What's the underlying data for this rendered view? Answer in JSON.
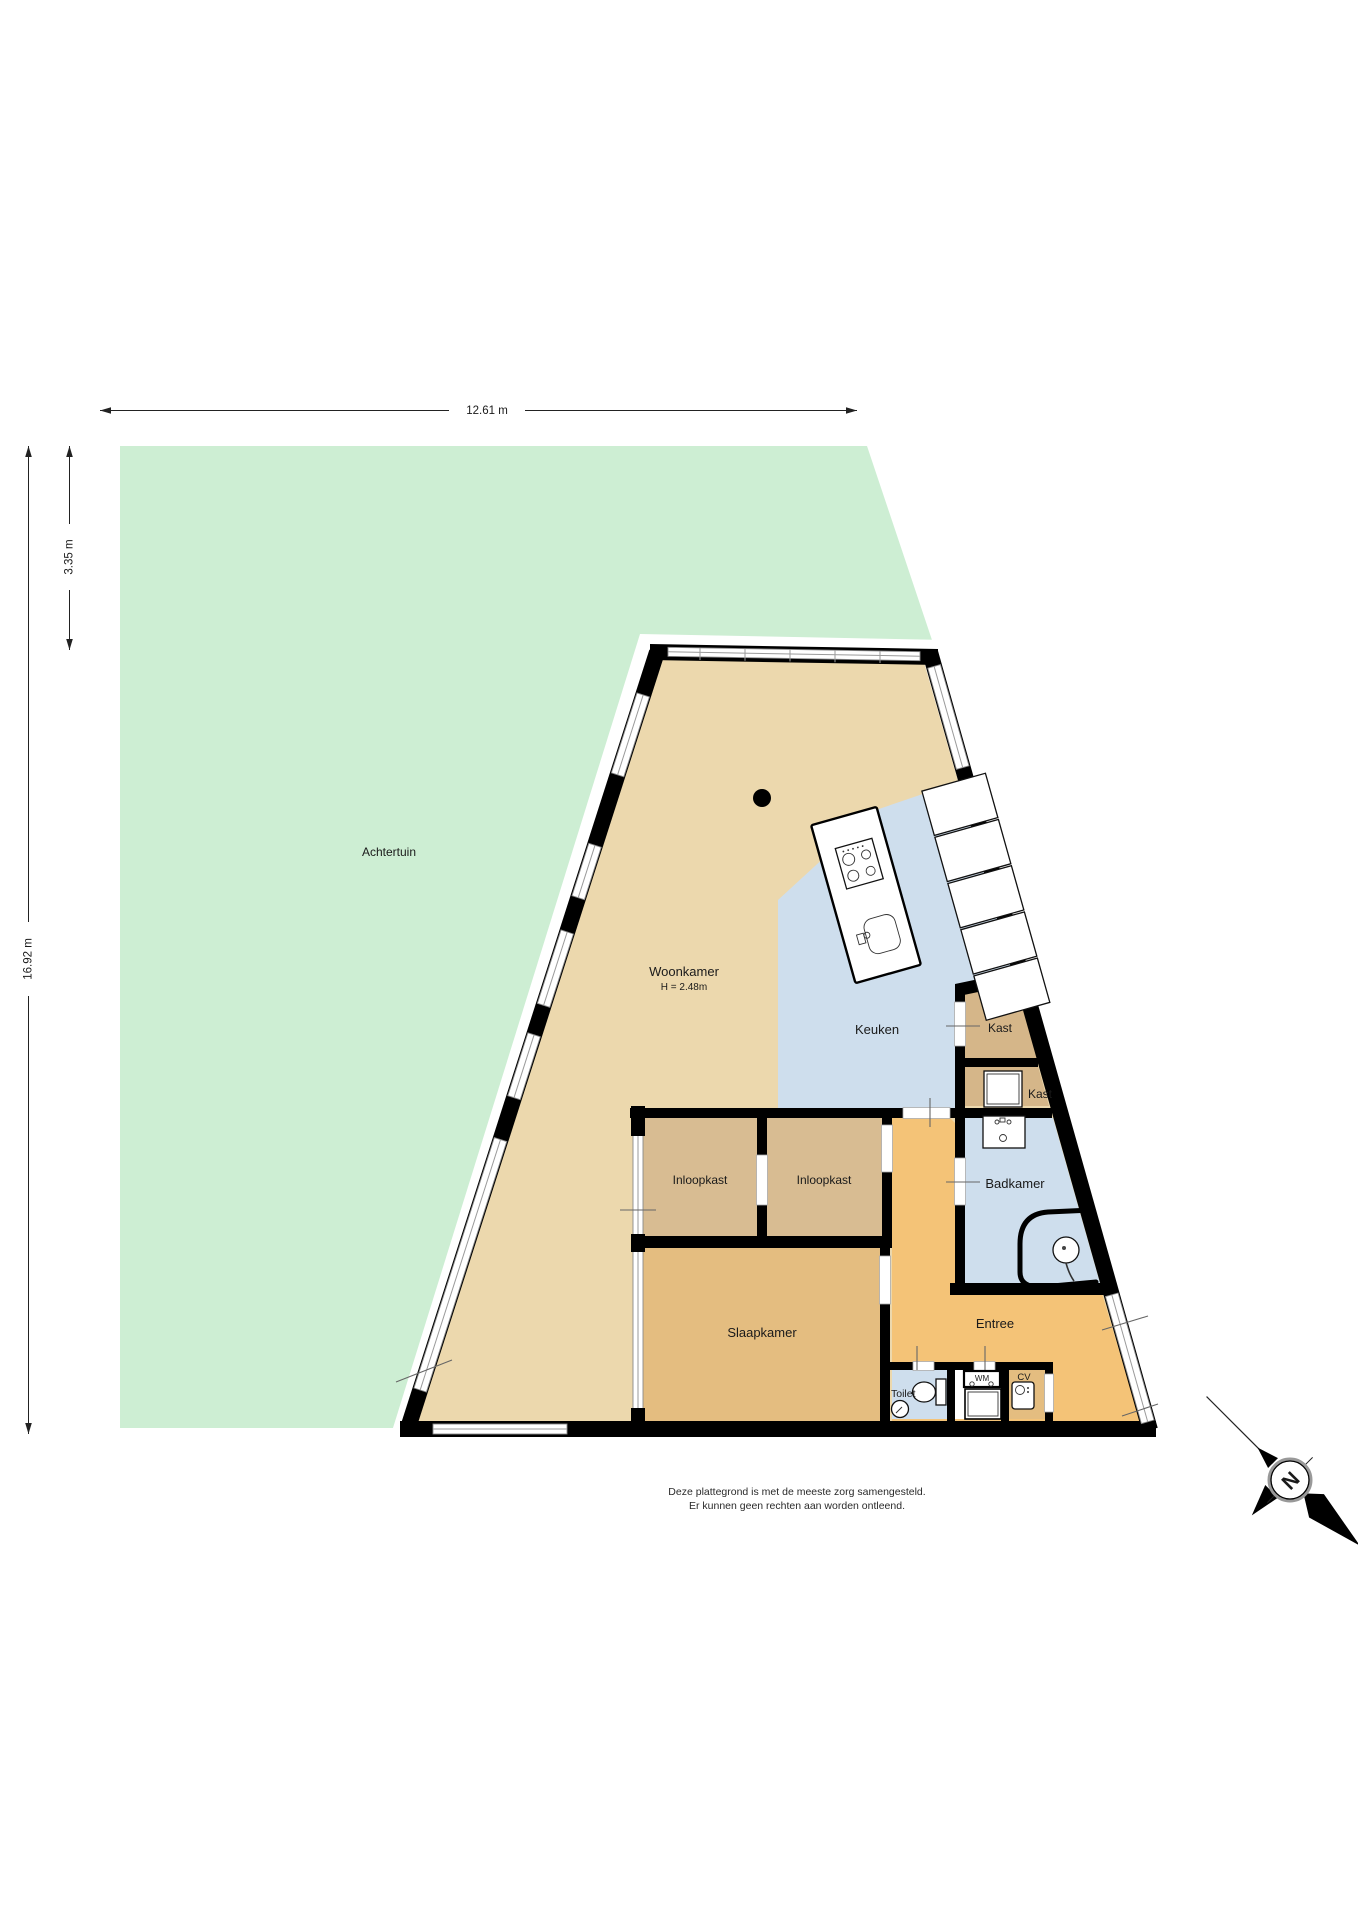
{
  "title": "Plattegrond begane grond",
  "labels": {
    "achtertuin": "Achtertuin",
    "woonkamer": "Woonkamer",
    "woonkamer_h": "H = 2.48m",
    "keuken": "Keuken",
    "kast_upper": "Kast",
    "kast_lower": "Kast",
    "badkamer": "Badkamer",
    "inloopkast_left": "Inloopkast",
    "inloopkast_right": "Inloopkast",
    "slaapkamer": "Slaapkamer",
    "entree": "Entree",
    "toilet": "Toilet",
    "wm": "WM",
    "cv": "CV"
  },
  "dimensions": {
    "width": "12.61 m",
    "garden_depth": "3.35 m",
    "total_depth": "16.92 m"
  },
  "compass": {
    "north": "N"
  },
  "disclaimer": {
    "line1": "Deze plattegrond is met de meeste zorg samengesteld.",
    "line2": "Er kunnen geen rechten aan worden ontleend."
  },
  "colors": {
    "garden": "#cdeed3",
    "woonkamer": "#ecd8ad",
    "keuken": "#cedeed",
    "kast": "#d5b689",
    "inloopkast": "#d8bc92",
    "slaapkamer": "#e4bd80",
    "entree": "#f4c377",
    "badkamer": "#cedeed",
    "toilet": "#cedeed",
    "wall": "#000000"
  }
}
